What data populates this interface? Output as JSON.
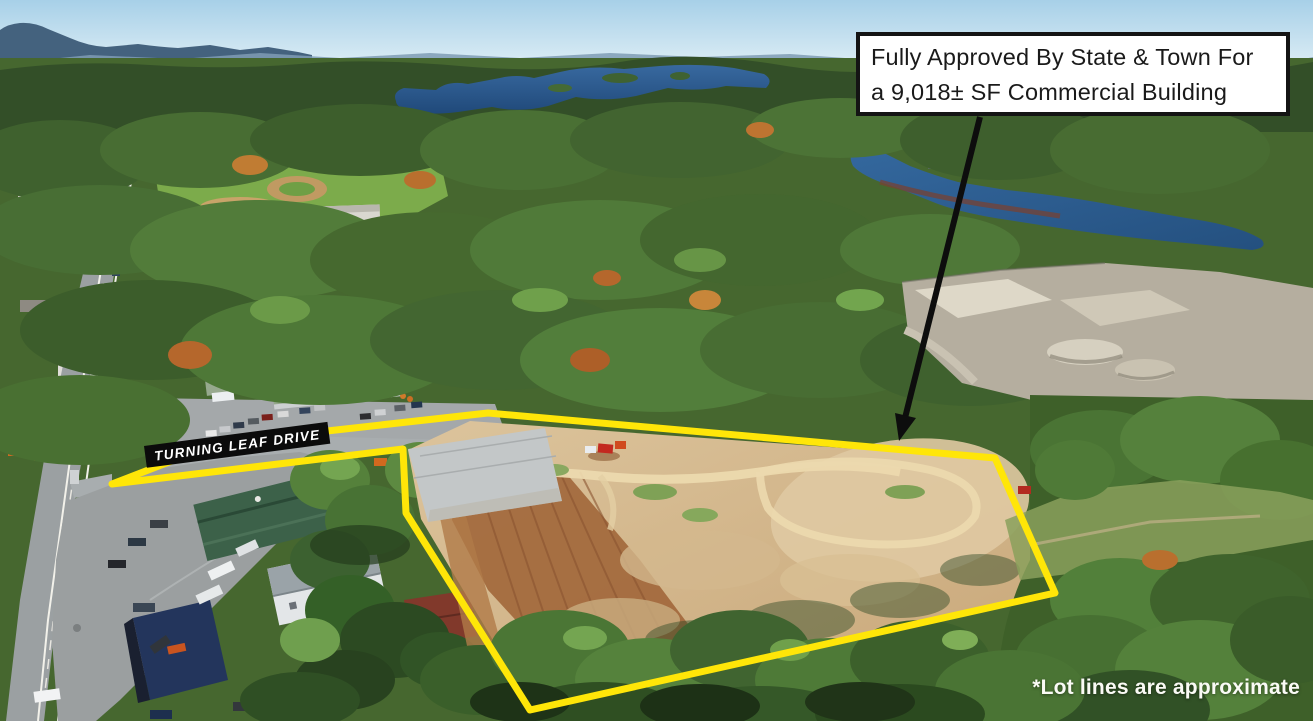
{
  "annotation_box": {
    "line1": "Fully Approved By State & Town For",
    "line2": "a 9,018± SF Commercial Building",
    "background": "#ffffff",
    "border_color": "#141414",
    "text_color": "#1a1a1a"
  },
  "road_label": {
    "text": "TURNING LEAF DRIVE",
    "background": "#0b0b0b",
    "text_color": "#ffffff"
  },
  "disclaimer": {
    "text": "*Lot lines are approximate",
    "text_color": "#fafaf5"
  },
  "property_boundary": {
    "points": "112,484 200,450 300,434 488,413 995,458 1055,593 530,710 406,513 403,449",
    "color": "#ffe608",
    "stroke_width": "7"
  },
  "pointer_arrow": {
    "shaft": "M980,117 L904,422",
    "head": "899,441 895,413 916,418",
    "color": "#0d0d0d"
  }
}
